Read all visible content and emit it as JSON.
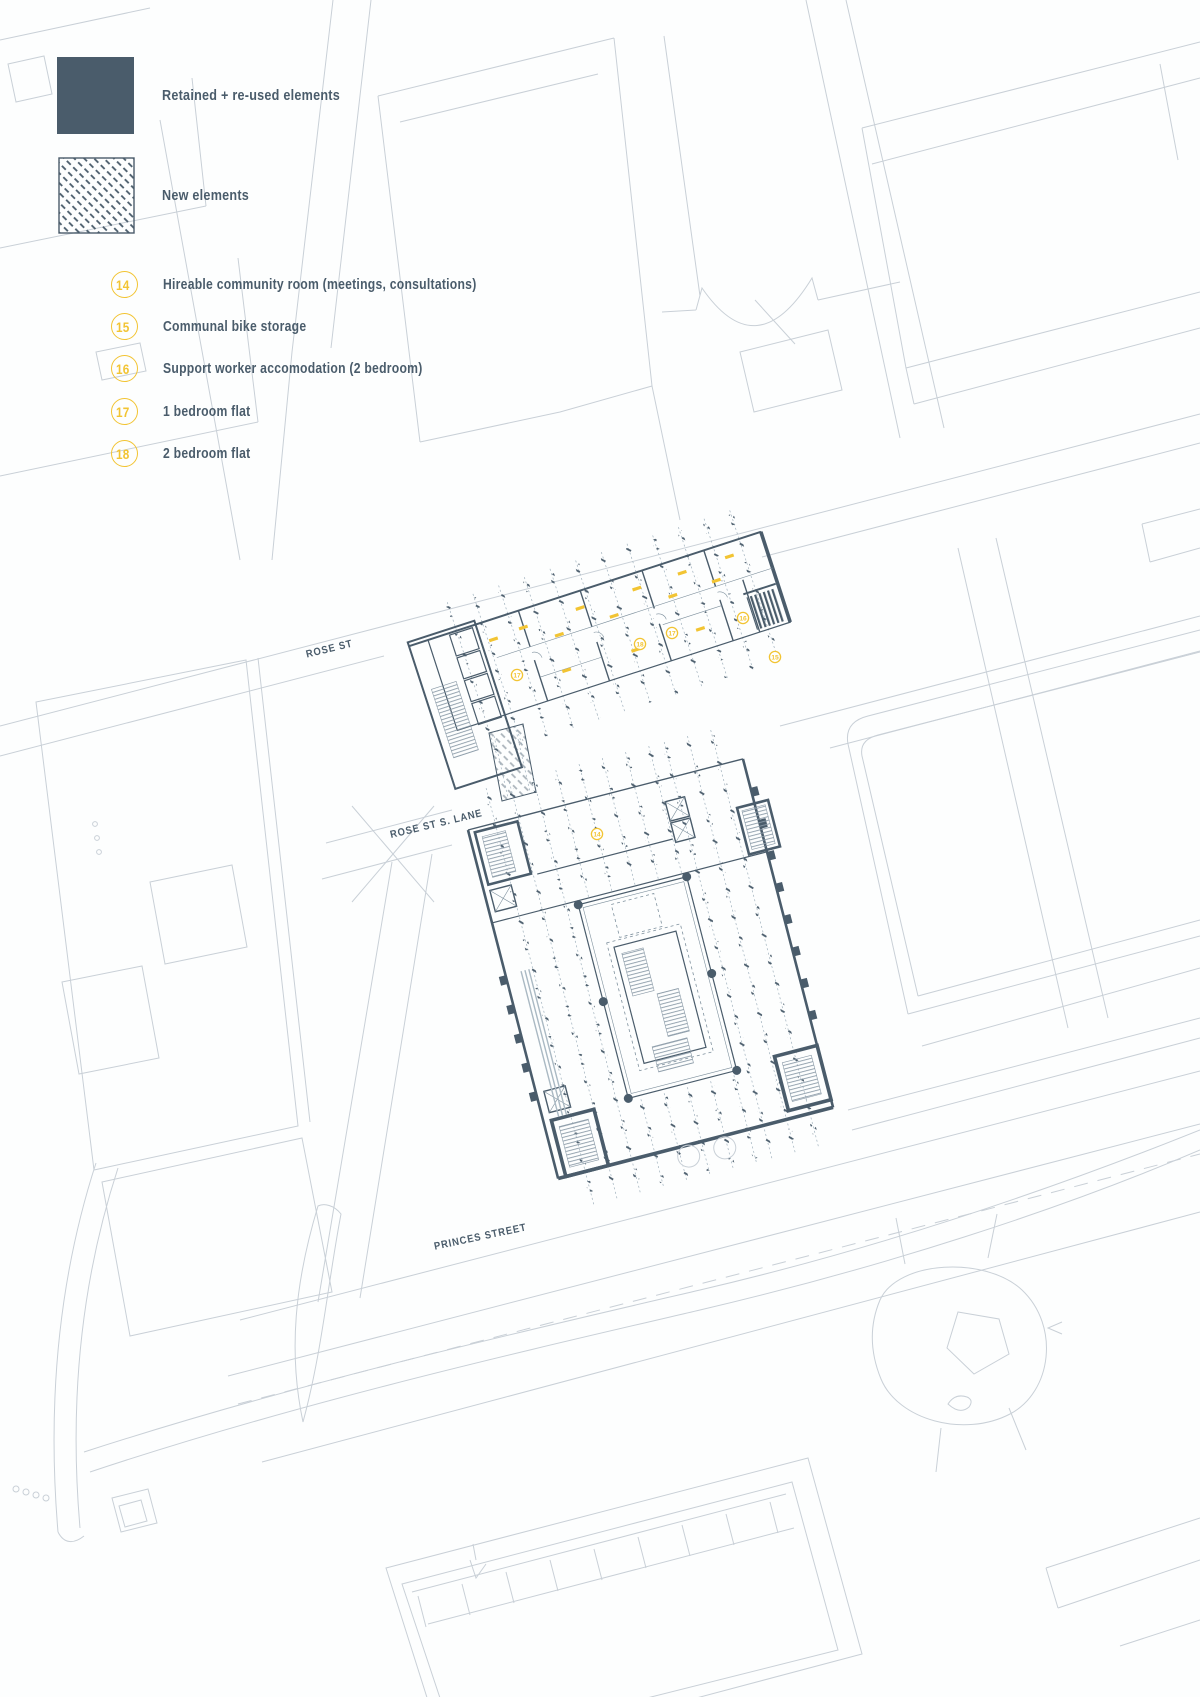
{
  "legend": {
    "swatches": [
      {
        "label": "Retained + re-used elements",
        "style": "solid"
      },
      {
        "label": "New elements",
        "style": "hatched"
      }
    ],
    "items": [
      {
        "number": "14",
        "label": "Hireable community room (meetings, consultations)"
      },
      {
        "number": "15",
        "label": "Communal bike storage"
      },
      {
        "number": "16",
        "label": "Support worker accomodation (2 bedroom)"
      },
      {
        "number": "17",
        "label": "1 bedroom flat"
      },
      {
        "number": "18",
        "label": "2 bedroom flat"
      }
    ]
  },
  "map": {
    "street_labels": [
      {
        "id": "rose-st",
        "text": "ROSE ST"
      },
      {
        "id": "rose-st-s-lane",
        "text": "ROSE ST S. LANE"
      },
      {
        "id": "princes-street",
        "text": "PRINCES STREET"
      }
    ],
    "plan_markers": [
      {
        "number": "17"
      },
      {
        "number": "18"
      },
      {
        "number": "17"
      },
      {
        "number": "16"
      },
      {
        "number": "15"
      },
      {
        "number": "14"
      }
    ],
    "colors": {
      "plan": "#4A5C6B",
      "context": "#C9D0D7",
      "accent": "#F2C433"
    }
  }
}
